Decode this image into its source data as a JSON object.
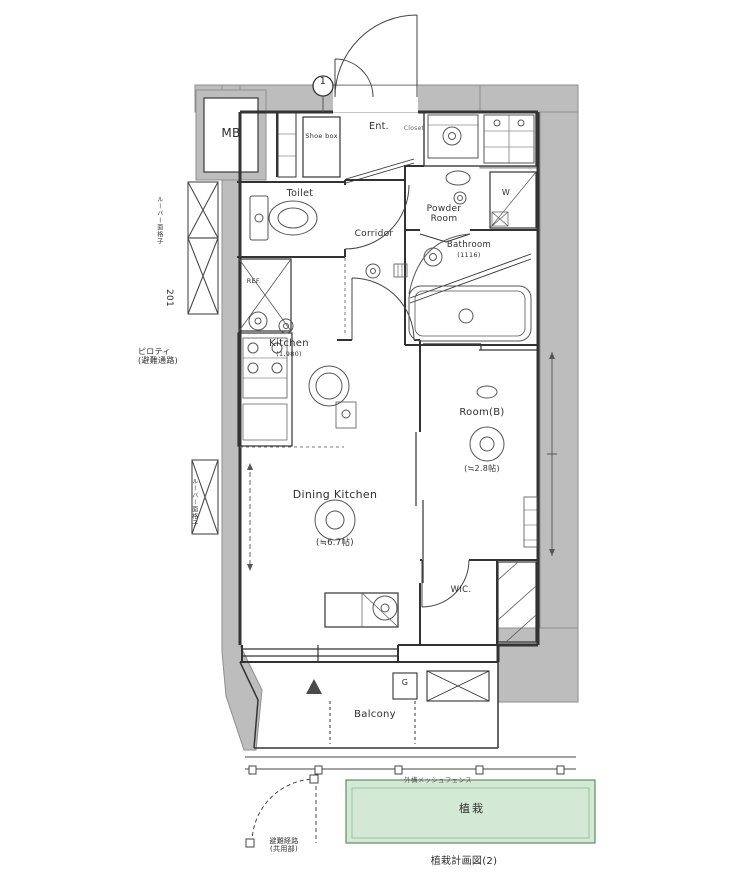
{
  "marker_1": "1",
  "rooms": {
    "mb": "MB",
    "entrance": {
      "label": "Ent.",
      "note": "Closet"
    },
    "shoe_box": "Shoe box",
    "toilet": "Toilet",
    "corridor": "Corridor",
    "powder_room": "Powder Room",
    "bathroom": {
      "label": "Bathroom",
      "size": "(1116)"
    },
    "kitchen": {
      "label": "Kitchen",
      "size": "(1,980)"
    },
    "dining_kitchen": {
      "label": "Dining Kitchen",
      "size": "(≒6.7帖)"
    },
    "room_b": {
      "label": "Room(B)",
      "size": "(≒2.8帖)"
    },
    "wic": "WIC.",
    "balcony": "Balcony"
  },
  "fixtures": {
    "refrigerator": "REF.",
    "washing_machine": "W",
    "water_heater": "G"
  },
  "annotations": {
    "piloti": "ピロティ\n(避難通路)",
    "grille_top": "ルーバー面格子",
    "unit_number": "201",
    "grille_bottom": "ルーバー面格子",
    "gate_note": "避難経路\n(共用部)",
    "fence_note": "外構メッシュフェンス",
    "planting": "植栽",
    "caption": "植栽計画図(2)"
  },
  "colors": {
    "structure_gray": "#bdbdbd",
    "wall_line": "#333333",
    "planting_fill": "#d3e9d5",
    "planting_border": "#5e8e62"
  }
}
